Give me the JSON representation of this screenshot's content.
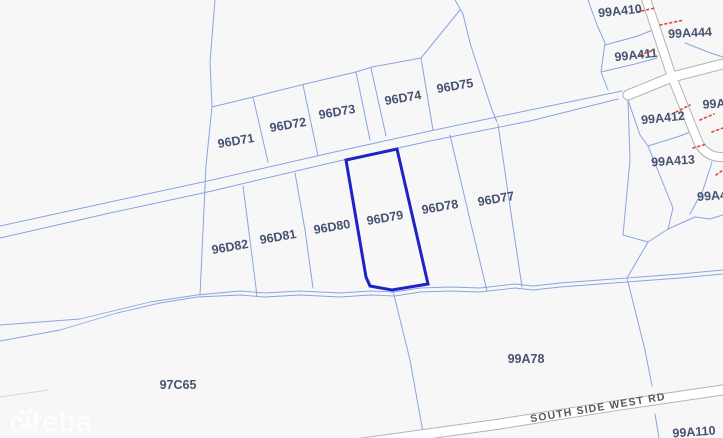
{
  "map": {
    "selected_parcel_id": "96D79",
    "colors": {
      "background": "#f7f7f8",
      "parcel_line": "#8aa4e0",
      "highlight": "#1c24c8",
      "parcel_label": "#46526f",
      "road_casing": "#b3b3b3",
      "road_fill": "#ffffff",
      "road_label": "#575757",
      "red_dash": "#dd4a3c",
      "watermark": "rgba(255,255,255,0.85)"
    },
    "parcel_labels": [
      {
        "id": "96D71",
        "x": 236,
        "y": 141,
        "rot": -10
      },
      {
        "id": "96D72",
        "x": 288,
        "y": 125,
        "rot": -10
      },
      {
        "id": "96D73",
        "x": 337,
        "y": 112,
        "rot": -10
      },
      {
        "id": "96D74",
        "x": 403,
        "y": 98,
        "rot": -10
      },
      {
        "id": "96D75",
        "x": 455,
        "y": 86,
        "rot": -10
      },
      {
        "id": "96D82",
        "x": 230,
        "y": 247,
        "rot": -10
      },
      {
        "id": "96D81",
        "x": 278,
        "y": 237,
        "rot": -10
      },
      {
        "id": "96D80",
        "x": 332,
        "y": 227,
        "rot": -10
      },
      {
        "id": "96D79",
        "x": 385,
        "y": 218,
        "rot": -10
      },
      {
        "id": "96D78",
        "x": 440,
        "y": 207,
        "rot": -10
      },
      {
        "id": "96D77",
        "x": 496,
        "y": 199,
        "rot": -10
      },
      {
        "id": "97C65",
        "x": 178,
        "y": 385,
        "rot": 0
      },
      {
        "id": "99A78",
        "x": 526,
        "y": 359,
        "rot": 0
      },
      {
        "id": "99A410",
        "x": 620,
        "y": 11,
        "rot": -6
      },
      {
        "id": "99A444",
        "x": 690,
        "y": 33,
        "rot": -3
      },
      {
        "id": "99A411",
        "x": 636,
        "y": 55,
        "rot": -6
      },
      {
        "id": "99A412",
        "x": 663,
        "y": 118,
        "rot": -6
      },
      {
        "id": "99A413",
        "x": 673,
        "y": 161,
        "rot": -4
      },
      {
        "id": "99A110",
        "x": 694,
        "y": 432,
        "rot": -4
      },
      {
        "id": "99A",
        "x": 714,
        "y": 104,
        "rot": -4
      },
      {
        "id": "99A4",
        "x": 712,
        "y": 196,
        "rot": -4
      }
    ],
    "road_labels": [
      {
        "name": "SOUTH SIDE WEST RD",
        "x": 598,
        "y": 408,
        "rot": -9.5
      }
    ],
    "watermark": {
      "text": "cireba"
    }
  }
}
